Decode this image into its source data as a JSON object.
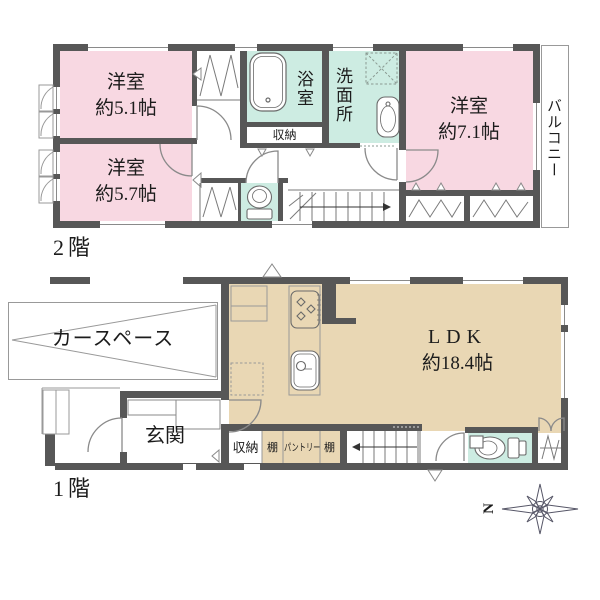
{
  "colors": {
    "wall": "#575757",
    "room_pink": "#f8d8e2",
    "room_mint": "#cdece2",
    "room_tan": "#e9d7b4",
    "outline": "#999999",
    "text": "#1c1c1c"
  },
  "floor2": {
    "floor_label": "2階",
    "bedroom_small": {
      "name": "洋室",
      "size": "約5.1帖"
    },
    "bedroom_mid": {
      "name": "洋室",
      "size": "約5.7帖"
    },
    "bedroom_large": {
      "name": "洋室",
      "size": "約7.1帖"
    },
    "bath_label": "浴室",
    "washroom_label": "洗面所",
    "closet_label": "収納",
    "balcony_label": "バルコニー"
  },
  "floor1": {
    "floor_label": "1階",
    "carspace_label": "カースペース",
    "entrance_label": "玄関",
    "storage_label": "収納",
    "shelf_left_label": "棚",
    "pantry_label": "パントリー",
    "shelf_right_label": "棚",
    "ldk": {
      "name": "LDK",
      "size": "約18.4帖"
    }
  },
  "compass": {
    "north_label": "N"
  }
}
